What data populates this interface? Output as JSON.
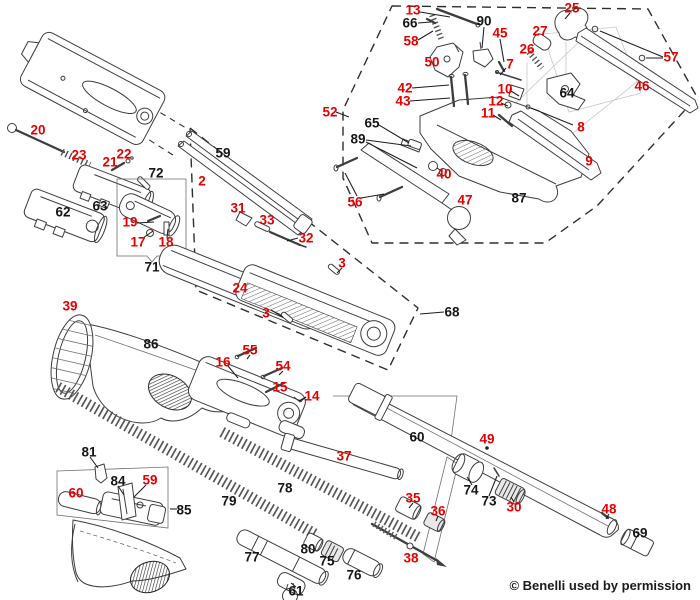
{
  "diagram": {
    "type": "exploded-parts-diagram",
    "subject": "Benelli shotgun schematic",
    "copyright": "© Benelli used by permission",
    "colors": {
      "red_label": "#e60000",
      "black_label": "#161616",
      "line": "#3d3d3d"
    },
    "labels": [
      {
        "num": "13",
        "color": "red",
        "x": 413,
        "y": 10
      },
      {
        "num": "66",
        "color": "black",
        "x": 410,
        "y": 23
      },
      {
        "num": "58",
        "color": "red",
        "x": 411,
        "y": 41
      },
      {
        "num": "90",
        "color": "black",
        "x": 484,
        "y": 21
      },
      {
        "num": "45",
        "color": "red",
        "x": 500,
        "y": 33
      },
      {
        "num": "25",
        "color": "red",
        "x": 572,
        "y": 8
      },
      {
        "num": "27",
        "color": "red",
        "x": 540,
        "y": 31
      },
      {
        "num": "26",
        "color": "red",
        "x": 527,
        "y": 49
      },
      {
        "num": "7",
        "color": "red",
        "x": 510,
        "y": 64
      },
      {
        "num": "57",
        "color": "red",
        "x": 671,
        "y": 57
      },
      {
        "num": "46",
        "color": "red",
        "x": 642,
        "y": 86
      },
      {
        "num": "50",
        "color": "red",
        "x": 432,
        "y": 62
      },
      {
        "num": "42",
        "color": "red",
        "x": 405,
        "y": 88
      },
      {
        "num": "43",
        "color": "red",
        "x": 403,
        "y": 101
      },
      {
        "num": "10",
        "color": "red",
        "x": 505,
        "y": 89
      },
      {
        "num": "12",
        "color": "red",
        "x": 496,
        "y": 101
      },
      {
        "num": "11",
        "color": "red",
        "x": 488,
        "y": 113
      },
      {
        "num": "64",
        "color": "black",
        "x": 567,
        "y": 93
      },
      {
        "num": "8",
        "color": "red",
        "x": 581,
        "y": 127
      },
      {
        "num": "65",
        "color": "black",
        "x": 372,
        "y": 123
      },
      {
        "num": "89",
        "color": "black",
        "x": 358,
        "y": 139
      },
      {
        "num": "9",
        "color": "red",
        "x": 589,
        "y": 161
      },
      {
        "num": "40",
        "color": "red",
        "x": 444,
        "y": 174
      },
      {
        "num": "56",
        "color": "red",
        "x": 355,
        "y": 202
      },
      {
        "num": "47",
        "color": "red",
        "x": 465,
        "y": 200
      },
      {
        "num": "87",
        "color": "black",
        "x": 519,
        "y": 198
      },
      {
        "num": "52",
        "color": "red",
        "x": 330,
        "y": 112
      },
      {
        "num": "20",
        "color": "red",
        "x": 38,
        "y": 130
      },
      {
        "num": "23",
        "color": "red",
        "x": 79,
        "y": 155
      },
      {
        "num": "21",
        "color": "red",
        "x": 110,
        "y": 162
      },
      {
        "num": "22",
        "color": "red",
        "x": 124,
        "y": 154
      },
      {
        "num": "72",
        "color": "black",
        "x": 156,
        "y": 173
      },
      {
        "num": "63",
        "color": "black",
        "x": 100,
        "y": 206
      },
      {
        "num": "62",
        "color": "black",
        "x": 63,
        "y": 212
      },
      {
        "num": "19",
        "color": "red",
        "x": 130,
        "y": 222
      },
      {
        "num": "17",
        "color": "red",
        "x": 138,
        "y": 242
      },
      {
        "num": "18",
        "color": "red",
        "x": 166,
        "y": 242
      },
      {
        "num": "71",
        "color": "black",
        "x": 152,
        "y": 267
      },
      {
        "num": "59",
        "color": "black",
        "x": 223,
        "y": 153
      },
      {
        "num": "2",
        "color": "red",
        "x": 202,
        "y": 181
      },
      {
        "num": "31",
        "color": "red",
        "x": 238,
        "y": 208
      },
      {
        "num": "33",
        "color": "red",
        "x": 267,
        "y": 220
      },
      {
        "num": "32",
        "color": "red",
        "x": 306,
        "y": 238
      },
      {
        "num": "3",
        "color": "red",
        "x": 342,
        "y": 263
      },
      {
        "num": "24",
        "color": "red",
        "x": 240,
        "y": 288
      },
      {
        "num": "3",
        "color": "red",
        "x": 266,
        "y": 313
      },
      {
        "num": "68",
        "color": "black",
        "x": 452,
        "y": 312
      },
      {
        "num": "39",
        "color": "red",
        "x": 70,
        "y": 306
      },
      {
        "num": "86",
        "color": "black",
        "x": 151,
        "y": 344
      },
      {
        "num": "55",
        "color": "red",
        "x": 250,
        "y": 350
      },
      {
        "num": "16",
        "color": "red",
        "x": 223,
        "y": 362
      },
      {
        "num": "54",
        "color": "red",
        "x": 283,
        "y": 366
      },
      {
        "num": "15",
        "color": "red",
        "x": 280,
        "y": 387
      },
      {
        "num": "14",
        "color": "red",
        "x": 312,
        "y": 396
      },
      {
        "num": "37",
        "color": "red",
        "x": 344,
        "y": 456
      },
      {
        "num": "81",
        "color": "black",
        "x": 89,
        "y": 452
      },
      {
        "num": "84",
        "color": "black",
        "x": 118,
        "y": 481
      },
      {
        "num": "59",
        "color": "red",
        "x": 150,
        "y": 480
      },
      {
        "num": "60",
        "color": "red",
        "x": 76,
        "y": 493
      },
      {
        "num": "85",
        "color": "black",
        "x": 184,
        "y": 510
      },
      {
        "num": "78",
        "color": "black",
        "x": 285,
        "y": 488
      },
      {
        "num": "79",
        "color": "black",
        "x": 229,
        "y": 501
      },
      {
        "num": "77",
        "color": "black",
        "x": 252,
        "y": 557
      },
      {
        "num": "80",
        "color": "black",
        "x": 308,
        "y": 549
      },
      {
        "num": "75",
        "color": "black",
        "x": 327,
        "y": 561
      },
      {
        "num": "76",
        "color": "black",
        "x": 354,
        "y": 575
      },
      {
        "num": "61",
        "color": "black",
        "x": 296,
        "y": 591
      },
      {
        "num": "38",
        "color": "red",
        "x": 411,
        "y": 558
      },
      {
        "num": "35",
        "color": "red",
        "x": 413,
        "y": 498
      },
      {
        "num": "36",
        "color": "red",
        "x": 438,
        "y": 511
      },
      {
        "num": "60",
        "color": "black",
        "x": 417,
        "y": 437
      },
      {
        "num": "49",
        "color": "red",
        "x": 487,
        "y": 439
      },
      {
        "num": "74",
        "color": "black",
        "x": 471,
        "y": 490
      },
      {
        "num": "73",
        "color": "black",
        "x": 489,
        "y": 501
      },
      {
        "num": "30",
        "color": "red",
        "x": 514,
        "y": 507
      },
      {
        "num": "48",
        "color": "red",
        "x": 609,
        "y": 509
      },
      {
        "num": "69",
        "color": "black",
        "x": 640,
        "y": 533
      }
    ]
  }
}
